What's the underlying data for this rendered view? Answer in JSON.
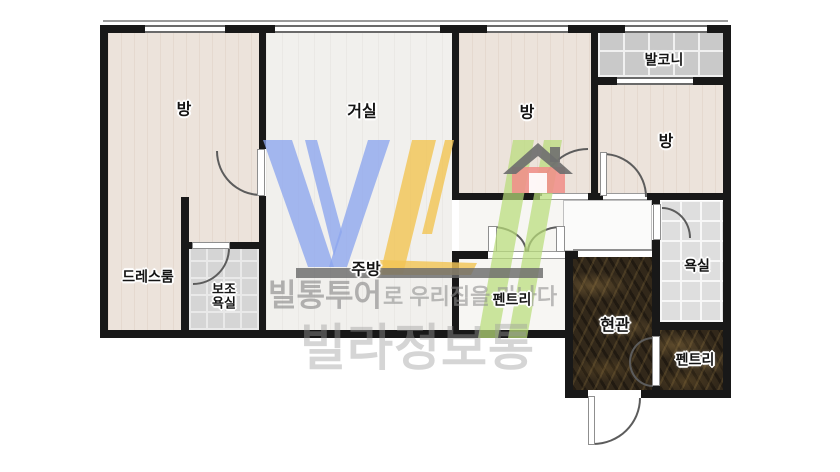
{
  "labels": {
    "bedroom1": "방",
    "living": "거실",
    "bedroom2": "방",
    "balcony": "발코니",
    "bedroom3": "방",
    "dressroom": "드레스룸",
    "auxbath_line1": "보조",
    "auxbath_line2": "욕실",
    "kitchen": "주방",
    "pantry_hall": "펜트리",
    "bathroom": "욕실",
    "entrance": "현관",
    "pantry_entry": "펜트리"
  },
  "watermark": {
    "logo": "VL",
    "tagline_bold": "빌통투어",
    "tagline_rest": "로 우리집을 만나다",
    "brand": "빌라정보통",
    "colors": {
      "blue": "#8CA5EE",
      "yellow": "#F2C455",
      "green": "#B9DC7A",
      "bar_gray": "#6B6B6B",
      "house_red": "#F0908A",
      "text_gray": "#9A9A9A"
    }
  }
}
